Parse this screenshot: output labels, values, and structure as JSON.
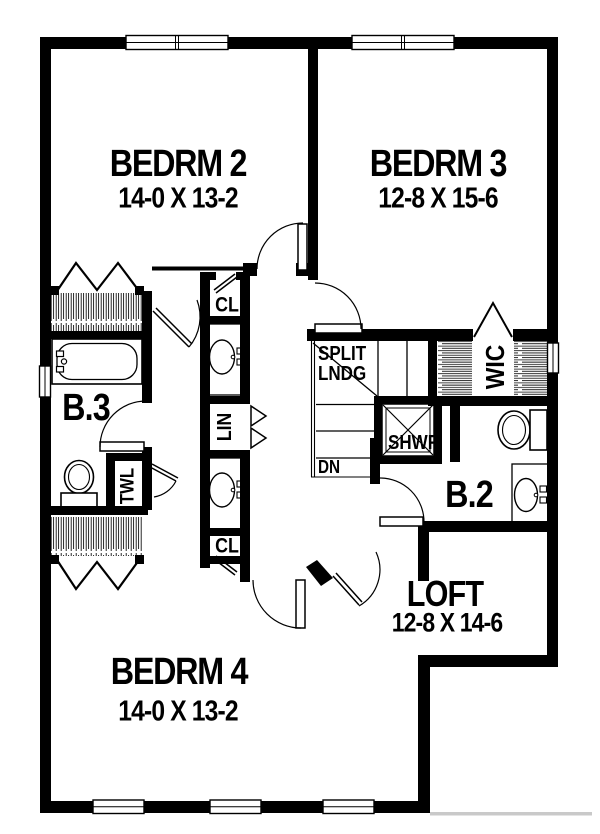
{
  "rooms": {
    "bedrm2": {
      "name": "BEDRM 2",
      "dims": "14-0 X 13-2"
    },
    "bedrm3": {
      "name": "BEDRM 3",
      "dims": "12-8 X 15-6"
    },
    "bedrm4": {
      "name": "BEDRM 4",
      "dims": "14-0 X 13-2"
    },
    "loft": {
      "name": "LOFT",
      "dims": "12-8 X 14-6"
    }
  },
  "areas": {
    "bath3": "B.3",
    "bath2": "B.2",
    "wic": "WIC",
    "linen": "LIN",
    "towel": "TWL",
    "closet_top": "CL",
    "closet_bottom": "CL",
    "shower": "SHWR",
    "split_landing_line1": "SPLIT",
    "split_landing_line2": "LNDG",
    "down": "DN"
  },
  "colors": {
    "wall": "#000000",
    "background": "#ffffff",
    "hatch": "#111111",
    "shadow": "#c9c9c9"
  }
}
